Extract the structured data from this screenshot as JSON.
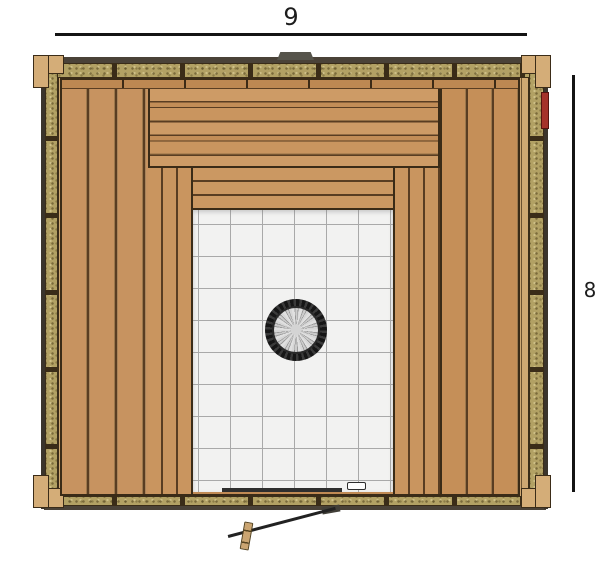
{
  "dimensions": {
    "width_label": "9",
    "depth_label": "8"
  },
  "drawing": {
    "parts": [
      "top-wall-insulated",
      "bottom-wall-insulated",
      "left-wall-insulated",
      "right-wall-insulated",
      "corner-posts",
      "back-bench-upper",
      "back-bench-lower",
      "left-bench",
      "left-bench-step",
      "right-bench",
      "right-bench-step",
      "tile-floor",
      "stone-heater",
      "door-threshold",
      "floor-vent",
      "open-door-leaf",
      "door-handle",
      "door-pivot",
      "red-marker",
      "roof-vent-tab"
    ]
  },
  "colors": {
    "wood_plank": "#c79360",
    "wood_gap": "#593d22",
    "wood_trim": "#cfa872",
    "insulation": "#b2a164",
    "insulation_frame": "#3a2c18",
    "tile": "#f2f2f1",
    "tile_grid": "#a9a9a9",
    "heater_ring": "#161616",
    "heater_stones": "#d6d6d6",
    "threshold": "#2e2e2e",
    "accent_red": "#a5322a",
    "vent_tab_gray": "#56544b",
    "dimension_line": "#141414"
  }
}
